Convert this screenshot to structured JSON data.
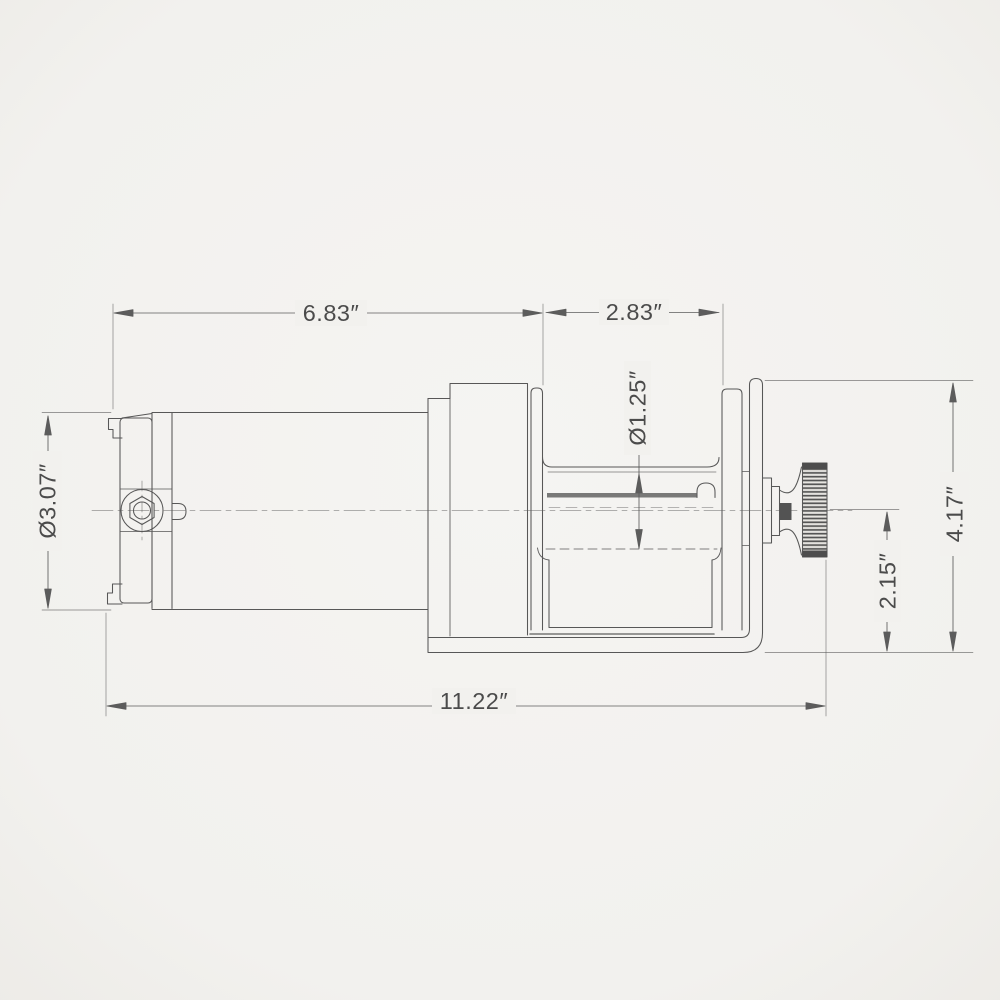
{
  "dimensions": {
    "upper_left_length": "6.83″",
    "upper_right_length": "2.83″",
    "drum_diameter": "Ø1.25″",
    "motor_diameter": "Ø3.07″",
    "overall_height": "4.17″",
    "centerline_height": "2.15″",
    "overall_length": "11.22″"
  },
  "colors": {
    "background": "#f2f1ee",
    "line": "#4a4a4a",
    "text": "#3c3c3c"
  }
}
